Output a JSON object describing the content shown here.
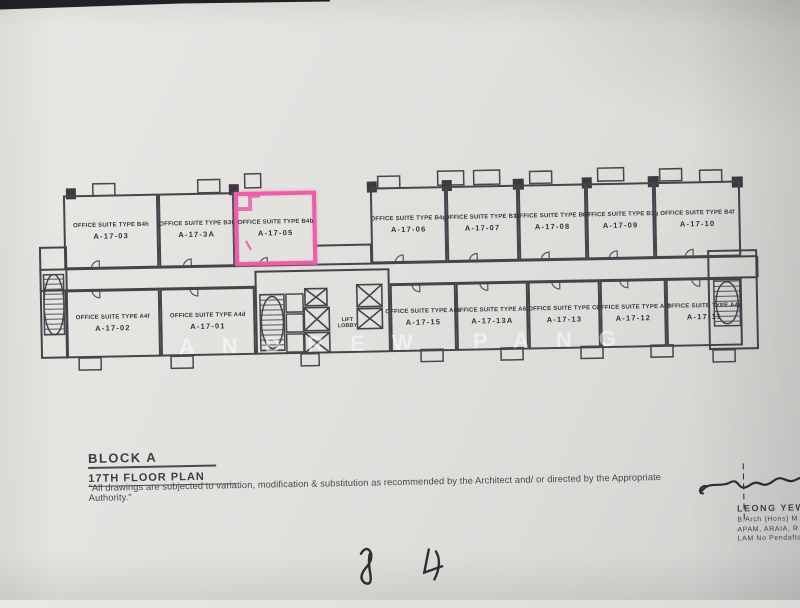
{
  "plan": {
    "watermark": "ANDREW PANG",
    "highlight_color": "#e95fa8",
    "wall_color": "#45444b",
    "lift_lobby": {
      "line1": "LIFT",
      "line2": "LOBBY"
    },
    "rooms": [
      {
        "type": "OFFICE SUITE TYPE B4h",
        "unit": "A-17-03"
      },
      {
        "type": "OFFICE SUITE TYPE B3f",
        "unit": "A-17-3A"
      },
      {
        "type": "OFFICE SUITE TYPE B4b",
        "unit": "A-17-05",
        "highlighted": true
      },
      {
        "type": "OFFICE SUITE TYPE B4g",
        "unit": "A-17-06"
      },
      {
        "type": "OFFICE SUITE TYPE B3a",
        "unit": "A-17-07"
      },
      {
        "type": "OFFICE SUITE TYPE B3c",
        "unit": "A-17-08"
      },
      {
        "type": "OFFICE SUITE TYPE B3g",
        "unit": "A-17-09"
      },
      {
        "type": "OFFICE SUITE TYPE B4f",
        "unit": "A-17-10"
      },
      {
        "type": "OFFICE SUITE TYPE A4f",
        "unit": "A-17-02"
      },
      {
        "type": "OFFICE SUITE TYPE A4d",
        "unit": "A-17-01"
      },
      {
        "type": "OFFICE SUITE TYPE A5b",
        "unit": "A-17-15"
      },
      {
        "type": "OFFICE SUITE TYPE A6c",
        "unit": "A-17-13A"
      },
      {
        "type": "OFFICE SUITE TYPE C2",
        "unit": "A-17-13"
      },
      {
        "type": "OFFICE SUITE TYPE A6f",
        "unit": "A-17-12"
      },
      {
        "type": "OFFICE SUITE TYPE A4g",
        "unit": "A-17-11"
      }
    ]
  },
  "title_block": {
    "block": "BLOCK A",
    "floor": "17TH FLOOR PLAN",
    "disclaimer": "\"All drawings are subjected to variation, modification & substitution as recommended by the Architect and/ or directed by the Appropriate Authority.\""
  },
  "signature_block": {
    "name": "LEONG YEW K",
    "line2": "B.Arch (Hons) M",
    "line3": "APAM, ARAIA, R",
    "line4": "LAM No Pendaftar"
  }
}
